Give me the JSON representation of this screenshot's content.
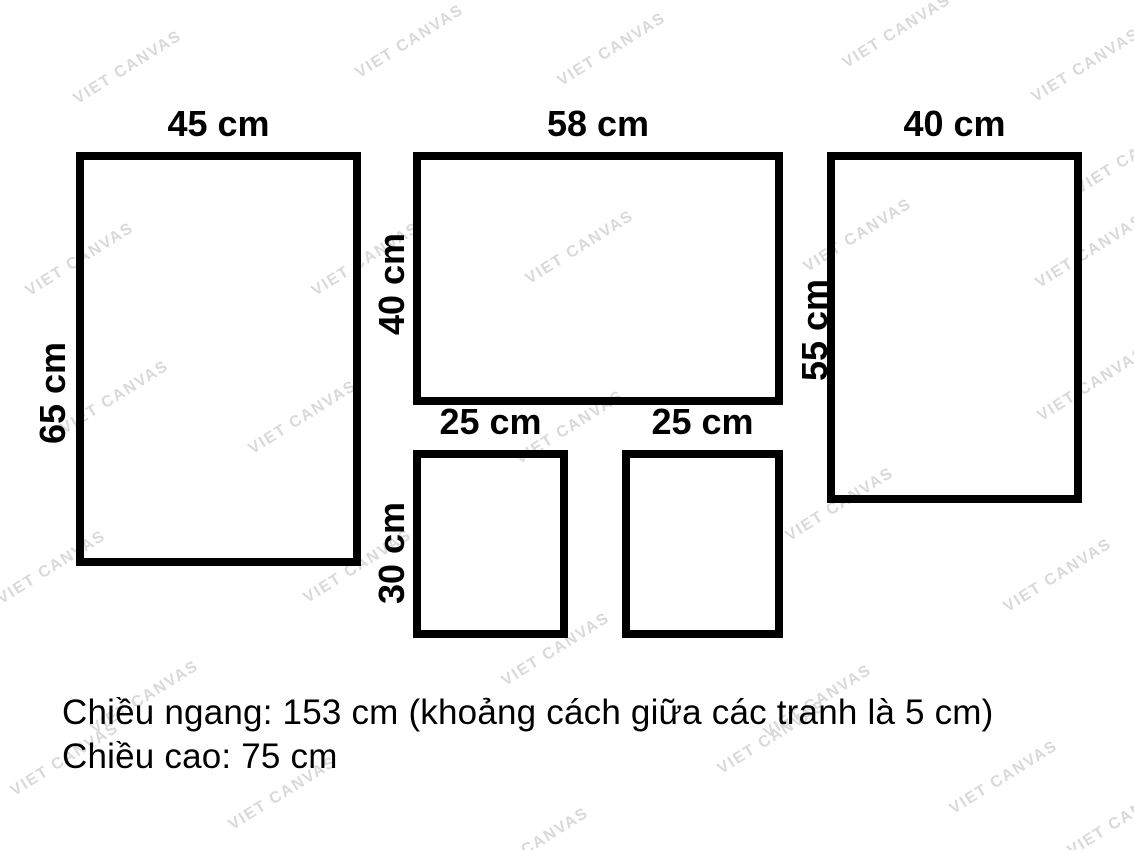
{
  "diagram": {
    "frames": [
      {
        "width_label": "45 cm",
        "height_label": "65 cm",
        "rect": {
          "x": 76,
          "y": 152,
          "w": 285,
          "h": 414
        },
        "hlabel_offset": {
          "dx": 23,
          "dy": 34
        }
      },
      {
        "width_label": "58 cm",
        "height_label": "40 cm",
        "rect": {
          "x": 413,
          "y": 152,
          "w": 370,
          "h": 253
        },
        "hlabel_offset": {
          "dx": 21,
          "dy": 5
        }
      },
      {
        "width_label": "40 cm",
        "height_label": "55 cm",
        "rect": {
          "x": 827,
          "y": 152,
          "w": 255,
          "h": 351
        },
        "hlabel_offset": {
          "dx": 12,
          "dy": 2
        }
      },
      {
        "width_label": "25 cm",
        "height_label": "30 cm",
        "rect": {
          "x": 413,
          "y": 450,
          "w": 155,
          "h": 188
        },
        "hlabel_offset": {
          "dx": 21,
          "dy": 9
        }
      },
      {
        "width_label": "25 cm",
        "height_label": null,
        "rect": {
          "x": 622,
          "y": 450,
          "w": 161,
          "h": 188
        }
      }
    ]
  },
  "footer": {
    "line1": "Chiều ngang: 153 cm (khoảng cách giữa các tranh là 5 cm)",
    "line2": "Chiều cao: 75 cm"
  },
  "watermark": {
    "text": "VIET CANVAS",
    "color": "#d9d9d9",
    "rotation_deg": -32,
    "positions": [
      [
        128,
        68
      ],
      [
        410,
        42
      ],
      [
        612,
        50
      ],
      [
        897,
        32
      ],
      [
        1086,
        66
      ],
      [
        1130,
        158
      ],
      [
        80,
        260
      ],
      [
        366,
        260
      ],
      [
        580,
        248
      ],
      [
        858,
        236
      ],
      [
        1090,
        252
      ],
      [
        115,
        398
      ],
      [
        303,
        418
      ],
      [
        570,
        428
      ],
      [
        840,
        505
      ],
      [
        1092,
        385
      ],
      [
        52,
        568
      ],
      [
        358,
        567
      ],
      [
        556,
        650
      ],
      [
        145,
        698
      ],
      [
        818,
        702
      ],
      [
        1058,
        576
      ],
      [
        65,
        760
      ],
      [
        283,
        794
      ],
      [
        535,
        845
      ],
      [
        772,
        738
      ],
      [
        1004,
        778
      ],
      [
        1122,
        820
      ]
    ]
  },
  "colors": {
    "border": "#000000",
    "label_text": "#000000",
    "background": "#ffffff"
  }
}
